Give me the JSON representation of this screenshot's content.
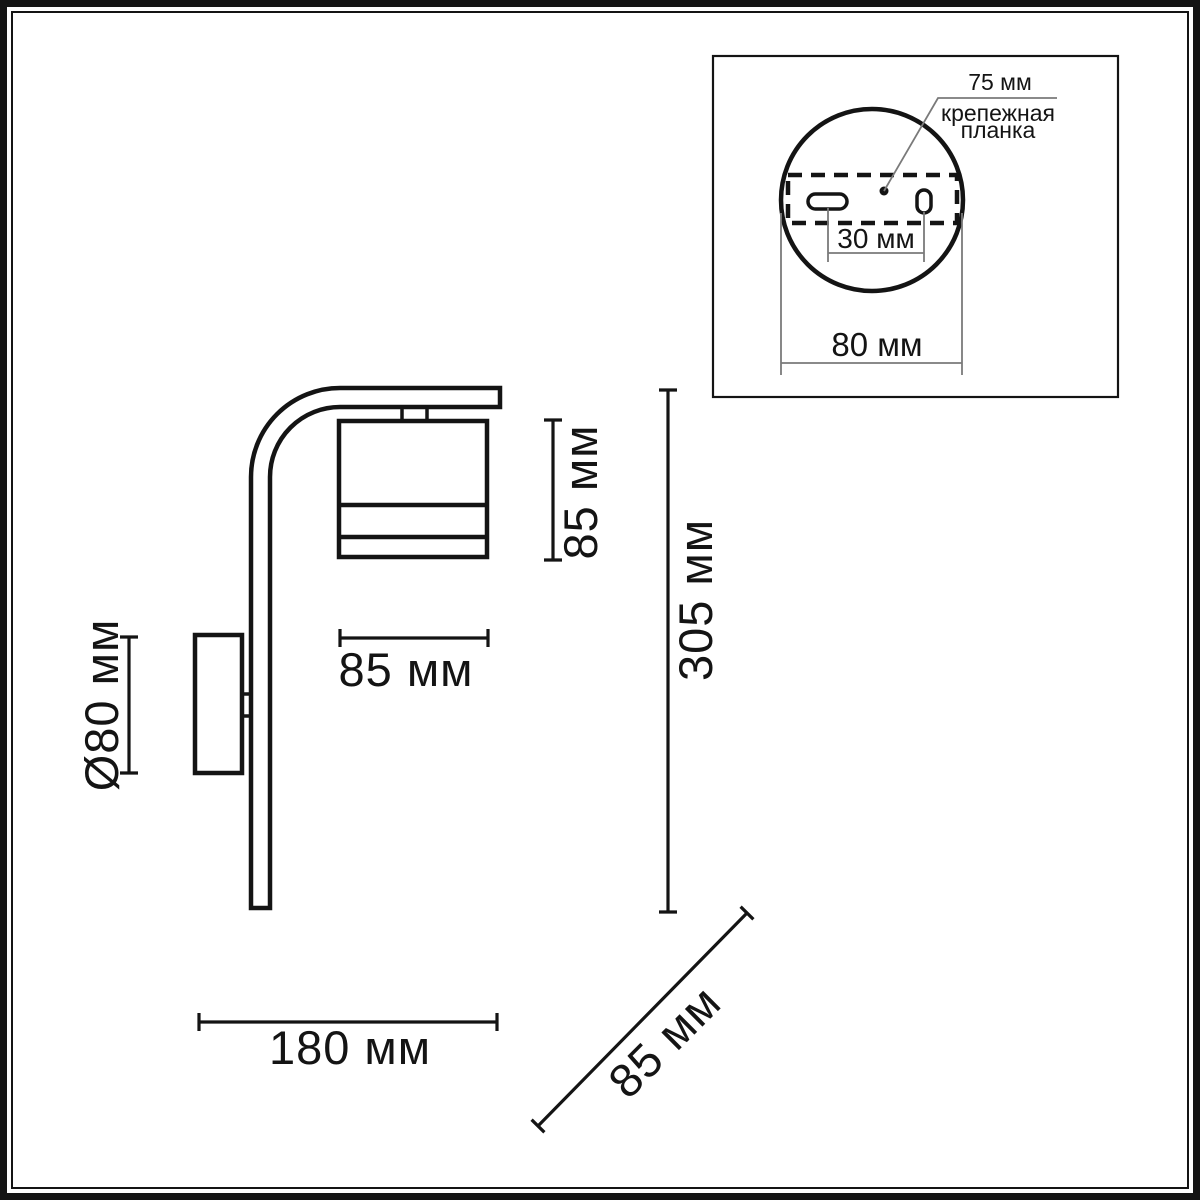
{
  "drawing": {
    "title": "wall-sconce-dimension-drawing",
    "dimensions": {
      "shade_height": "85 мм",
      "total_height": "305 мм",
      "shade_width": "85 мм",
      "base_diameter": "Ø80 мм",
      "total_width": "180 мм",
      "depth": "85 мм"
    },
    "inset": {
      "plate_width": "75 мм",
      "plate_label_line1": "крепежная",
      "plate_label_line2": "планка",
      "hole_spacing": "30 мм",
      "circle_diameter": "80 мм"
    },
    "colors": {
      "line": "#141414",
      "thin_line": "#7a7a7a",
      "background": "#ffffff"
    }
  }
}
